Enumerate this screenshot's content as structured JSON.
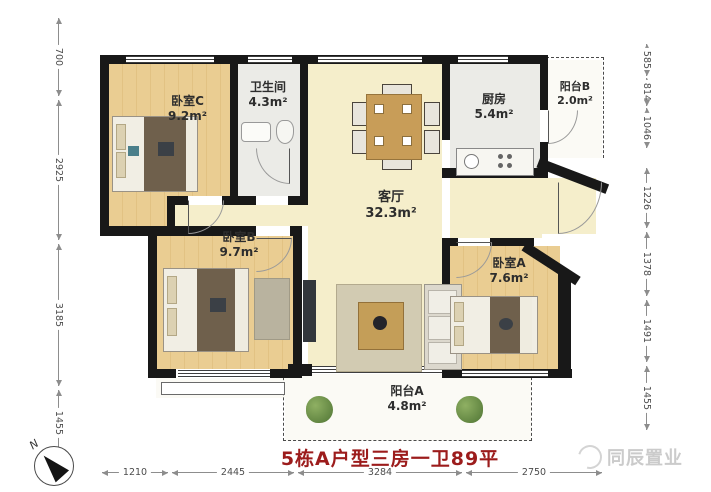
{
  "title": {
    "text": "5栋A户型三房一卫89平"
  },
  "watermark": {
    "text": "同辰置业"
  },
  "compass": {
    "label": "N"
  },
  "rooms": {
    "bedroomC": {
      "name": "卧室C",
      "area": "9.2m²"
    },
    "bathroom": {
      "name": "卫生间",
      "area": "4.3m²"
    },
    "kitchen": {
      "name": "厨房",
      "area": "5.4m²"
    },
    "balconyB": {
      "name": "阳台B",
      "area": "2.0m²"
    },
    "living": {
      "name": "客厅",
      "area": "32.3m²"
    },
    "bedroomB": {
      "name": "卧室B",
      "area": "9.7m²"
    },
    "bedroomA": {
      "name": "卧室A",
      "area": "7.6m²"
    },
    "balconyA": {
      "name": "阳台A",
      "area": "4.8m²"
    }
  },
  "dimensions": {
    "left": [
      "700",
      "2925",
      "3185",
      "1455"
    ],
    "right": [
      "585",
      "814",
      "1046",
      "1226",
      "1378",
      "1491",
      "1455"
    ],
    "bottom": [
      "1210",
      "2445",
      "3284",
      "2750"
    ]
  },
  "colors": {
    "wall": "#181818",
    "wood_floor": "#eacd92",
    "living_floor": "#f5eecb",
    "tile_floor": "#ebebe7",
    "title_red": "#9c1c1c"
  }
}
